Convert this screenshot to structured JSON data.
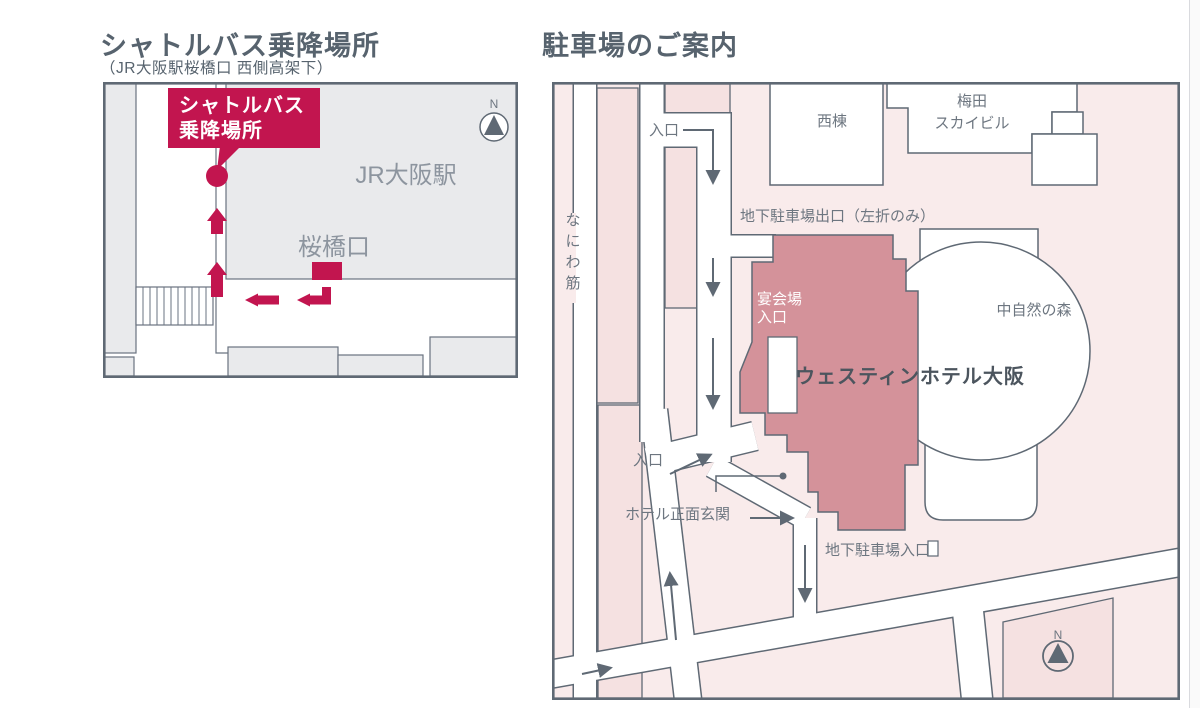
{
  "left_map": {
    "title": "シャトルバス乗降場所",
    "subtitle": "（JR大阪駅桜橋口 西側高架下）",
    "station_label": "JR大阪駅",
    "exit_label": "桜橋口",
    "stop_label_line1": "シャトルバス",
    "stop_label_line2": "乗降場所",
    "compass_n": "N"
  },
  "right_map": {
    "title": "駐車場のご案内",
    "street_label": "なにわ筋",
    "entrance_top_label": "入口",
    "garage_exit_label": "地下駐車場出口（左折のみ）",
    "west_wing_label": "西棟",
    "sky_building_line1": "梅田",
    "sky_building_line2": "スカイビル",
    "forest_label": "中自然の森",
    "banquet_line1": "宴会場",
    "banquet_line2": "入口",
    "hotel_label": "ウェスティンホテル大阪",
    "entrance_front_label": "入口",
    "front_entrance_label": "ホテル正面玄関",
    "garage_entrance_label": "地下駐車場入口",
    "compass_n": "N"
  },
  "colors": {
    "accent_crimson": "#c2154f",
    "line_dark": "#5f6974",
    "building_gray": "#e9eaec",
    "pink_background": "#f9ebeb",
    "pink_block": "#f5e1e1",
    "hotel_rose": "#d4929a"
  }
}
